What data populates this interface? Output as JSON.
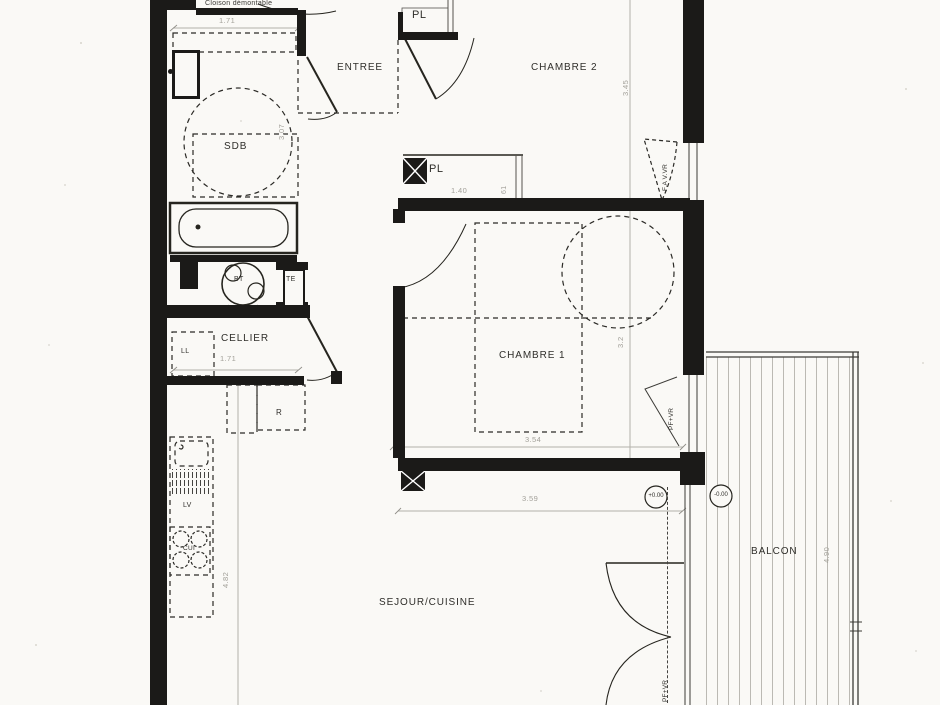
{
  "colors": {
    "paper": "#faf9f6",
    "ink": "#1b1a18",
    "dim_gray": "#a3a19a"
  },
  "rooms": {
    "entree": "ENTREE",
    "chambre2": "CHAMBRE 2",
    "chambre1": "CHAMBRE 1",
    "sdb": "SDB",
    "cellier": "CELLIER",
    "sejour": "SEJOUR/CUISINE",
    "balcon": "BALCON"
  },
  "closets": {
    "pl_entree": "PL",
    "pl_chambre": "PL"
  },
  "equipment": {
    "bt": "BT",
    "te": "TE",
    "ll": "LL",
    "lv": "LV",
    "fridge": "R",
    "cui": "CUI"
  },
  "windows": {
    "chambre2": "F.A V.VR",
    "chambre1": "PF+VR",
    "sejour": "PF+VR"
  },
  "annotations": {
    "cloison": "Cloison démontable"
  },
  "elevations": {
    "interior": "+0.00",
    "balcony": "-0.00"
  },
  "dimensions": {
    "sdb_width": "1.71",
    "sdb_height": "3.07",
    "pl_width": "1.40",
    "pl_depth": "61",
    "chambre2_height": "3.45",
    "chambre1_height": "3.2",
    "chambre1_width": "3.54",
    "cellier_width": "1.71",
    "cuisine_height": "4.82",
    "sejour_width": "3.59",
    "balcon_height": "4.90"
  }
}
